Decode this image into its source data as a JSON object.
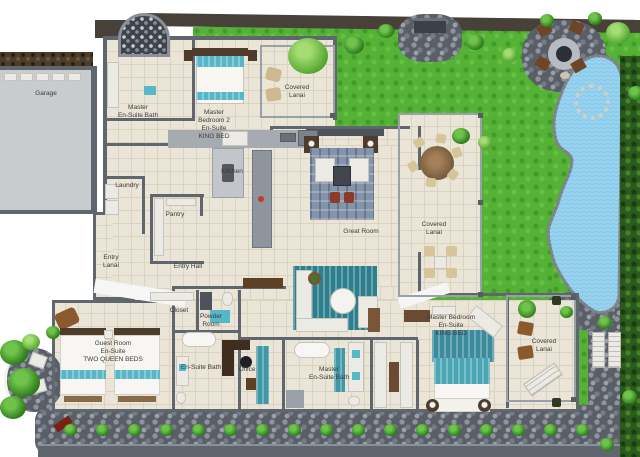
{
  "meta": {
    "width": 640,
    "height": 457,
    "type": "3d-floor-plan"
  },
  "palette": {
    "grass": "#55b237",
    "pool": "#8ccdec",
    "tile_floor": "#eae5d6",
    "wall": "#60666d",
    "stone": "#5a5f67",
    "hedge": "#2c5a1d",
    "teal_accent": "#57b7c6",
    "wood": "#7a5638",
    "label_text": "#3b3b3b"
  },
  "rooms": [
    {
      "id": "garage",
      "label": "Garage",
      "x": 46,
      "y": 94
    },
    {
      "id": "master-ensuite-bath-2",
      "label": "Master\nEn-Suite Bath",
      "x": 138,
      "y": 112
    },
    {
      "id": "master-bedroom-2",
      "label": "Master\nBedroom 2\nEn-Suite\nKING BED",
      "x": 214,
      "y": 125
    },
    {
      "id": "covered-lanai-top",
      "label": "Covered\nLanai",
      "x": 297,
      "y": 92
    },
    {
      "id": "laundry",
      "label": "Laundry",
      "x": 127,
      "y": 186
    },
    {
      "id": "kitchen",
      "label": "Kitchen",
      "x": 232,
      "y": 172
    },
    {
      "id": "pantry",
      "label": "Pantry",
      "x": 175,
      "y": 215
    },
    {
      "id": "entry-lanai",
      "label": "Entry\nLanai",
      "x": 111,
      "y": 262
    },
    {
      "id": "entry-hall",
      "label": "Entry Hall",
      "x": 188,
      "y": 267
    },
    {
      "id": "great-room",
      "label": "Great Room",
      "x": 361,
      "y": 232
    },
    {
      "id": "covered-lanai-right",
      "label": "Covered\nLanai",
      "x": 434,
      "y": 229
    },
    {
      "id": "closet",
      "label": "Closet",
      "x": 179,
      "y": 311
    },
    {
      "id": "powder-room",
      "label": "Powder\nRoom",
      "x": 211,
      "y": 321
    },
    {
      "id": "guest-room",
      "label": "Guest Room\nEn-Suite\nTWO QUEEN BEDS",
      "x": 113,
      "y": 352
    },
    {
      "id": "guest-ensuite-bath",
      "label": "En-Suite Bath",
      "x": 201,
      "y": 368
    },
    {
      "id": "office",
      "label": "Office",
      "x": 247,
      "y": 370
    },
    {
      "id": "master-ensuite-bath",
      "label": "Master\nEn-Suite Bath",
      "x": 329,
      "y": 374
    },
    {
      "id": "master-bedroom",
      "label": "Master Bedroom\nEn-Suite\nKING BED",
      "x": 451,
      "y": 326
    },
    {
      "id": "covered-lanai-bottom",
      "label": "Covered\nLanai",
      "x": 544,
      "y": 346
    }
  ],
  "landscape": {
    "bushes": [
      [
        64,
        424,
        13,
        0
      ],
      [
        96,
        424,
        13,
        0
      ],
      [
        128,
        424,
        13,
        0
      ],
      [
        160,
        424,
        13,
        0
      ],
      [
        192,
        424,
        13,
        0
      ],
      [
        224,
        424,
        13,
        0
      ],
      [
        256,
        424,
        13,
        0
      ],
      [
        288,
        424,
        13,
        0
      ],
      [
        320,
        424,
        13,
        0
      ],
      [
        352,
        424,
        13,
        0
      ],
      [
        384,
        424,
        13,
        0
      ],
      [
        416,
        424,
        13,
        0
      ],
      [
        448,
        424,
        13,
        0
      ],
      [
        480,
        424,
        13,
        0
      ],
      [
        512,
        424,
        13,
        0
      ],
      [
        544,
        424,
        13,
        0
      ],
      [
        576,
        424,
        13,
        0
      ],
      [
        598,
        316,
        14,
        0
      ],
      [
        622,
        390,
        15,
        0
      ],
      [
        600,
        438,
        14,
        0
      ],
      [
        560,
        306,
        13,
        0
      ],
      [
        344,
        36,
        20,
        0
      ],
      [
        378,
        24,
        16,
        0
      ],
      [
        466,
        34,
        18,
        0
      ],
      [
        502,
        48,
        15,
        1
      ],
      [
        540,
        14,
        14,
        0
      ],
      [
        452,
        128,
        18,
        0
      ],
      [
        478,
        136,
        14,
        1
      ],
      [
        606,
        22,
        24,
        1
      ],
      [
        588,
        12,
        14,
        0
      ],
      [
        628,
        86,
        16,
        0
      ],
      [
        288,
        38,
        40,
        1
      ],
      [
        0,
        340,
        28,
        0
      ],
      [
        8,
        368,
        32,
        0
      ],
      [
        0,
        396,
        26,
        0
      ],
      [
        22,
        334,
        18,
        1
      ],
      [
        46,
        326,
        14,
        0
      ]
    ]
  }
}
